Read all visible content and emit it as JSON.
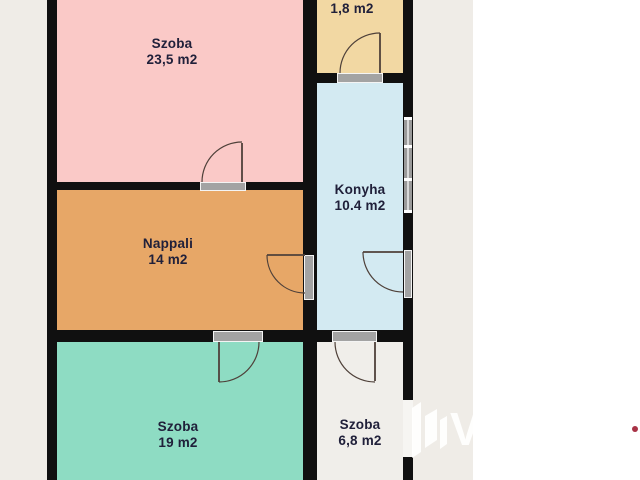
{
  "rooms": {
    "szoba_23_5": {
      "label": "Szoba",
      "area": "23,5 m2",
      "color": "#fac9c7"
    },
    "room_1_8": {
      "area": "1,8 m2",
      "color": "#f2d8a3"
    },
    "konyha": {
      "label": "Konyha",
      "area": "10.4 m2",
      "color": "#d3eaf2"
    },
    "nappali": {
      "label": "Nappali",
      "area": "14 m2",
      "color": "#e7a767"
    },
    "szoba_19": {
      "label": "Szoba",
      "area": "19 m2",
      "color": "#8edcc3"
    },
    "szoba_6_8": {
      "label": "Szoba",
      "area": "6,8 m2",
      "color": "#f0eeea"
    }
  },
  "colors": {
    "wall": "#101010",
    "plan_background": "#efece7",
    "page_background": "#ffffff",
    "door_threshold": "#a3a3a3",
    "window_gray": "#9a9a9a",
    "label_text": "#20203a",
    "door_swing_line": "#4f413a",
    "watermark": "#ffffff",
    "red_dot": "#a83246"
  }
}
